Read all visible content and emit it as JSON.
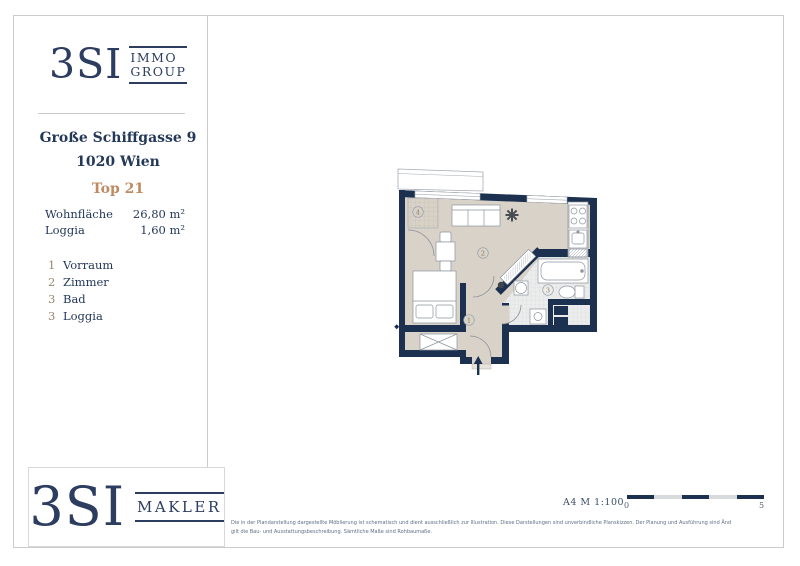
{
  "sidebar": {
    "logo": {
      "brand": "3SI",
      "sub_line1": "IMMO",
      "sub_line2": "GROUP"
    },
    "address_line1": "Große Schiffgasse 9",
    "address_line2": "1020 Wien",
    "unit": "Top 21",
    "areas": [
      {
        "label": "Wohnfläche",
        "value": "26,80 m²"
      },
      {
        "label": "Loggia",
        "value": "1,60 m²"
      }
    ],
    "legend": [
      {
        "num": "1",
        "label": "Vorraum"
      },
      {
        "num": "2",
        "label": "Zimmer"
      },
      {
        "num": "3",
        "label": "Bad"
      },
      {
        "num": "3",
        "label": "Loggia"
      }
    ]
  },
  "plan": {
    "room_numbers": {
      "vorraum": "1",
      "zimmer": "2",
      "bad": "3",
      "loggia": "4"
    },
    "colors": {
      "wall": "#1c3150",
      "floor": "#d9d2c8",
      "tile": "#ebecec",
      "accent": "#bf8a63",
      "navy_text": "#2c3d60"
    }
  },
  "footer": {
    "logo": {
      "brand": "3SI",
      "sub_line1": "MAKLER"
    },
    "disclaimer_line1": "Die in der Plandarstellung dargestellte Möblierung ist schematisch und dient ausschließlich zur Illustration. Diese Darstellungen sind unverbindliche Planskizzen. Der Planung und Ausführung sind Änderungen vorbehalten. Es",
    "disclaimer_line2": "gilt die Bau- und Ausstattungsbeschreibung. Sämtliche Maße sind Rohbaumaße.",
    "format_scale": "A4  M 1:100",
    "scale_start": "0",
    "scale_end": "5"
  }
}
